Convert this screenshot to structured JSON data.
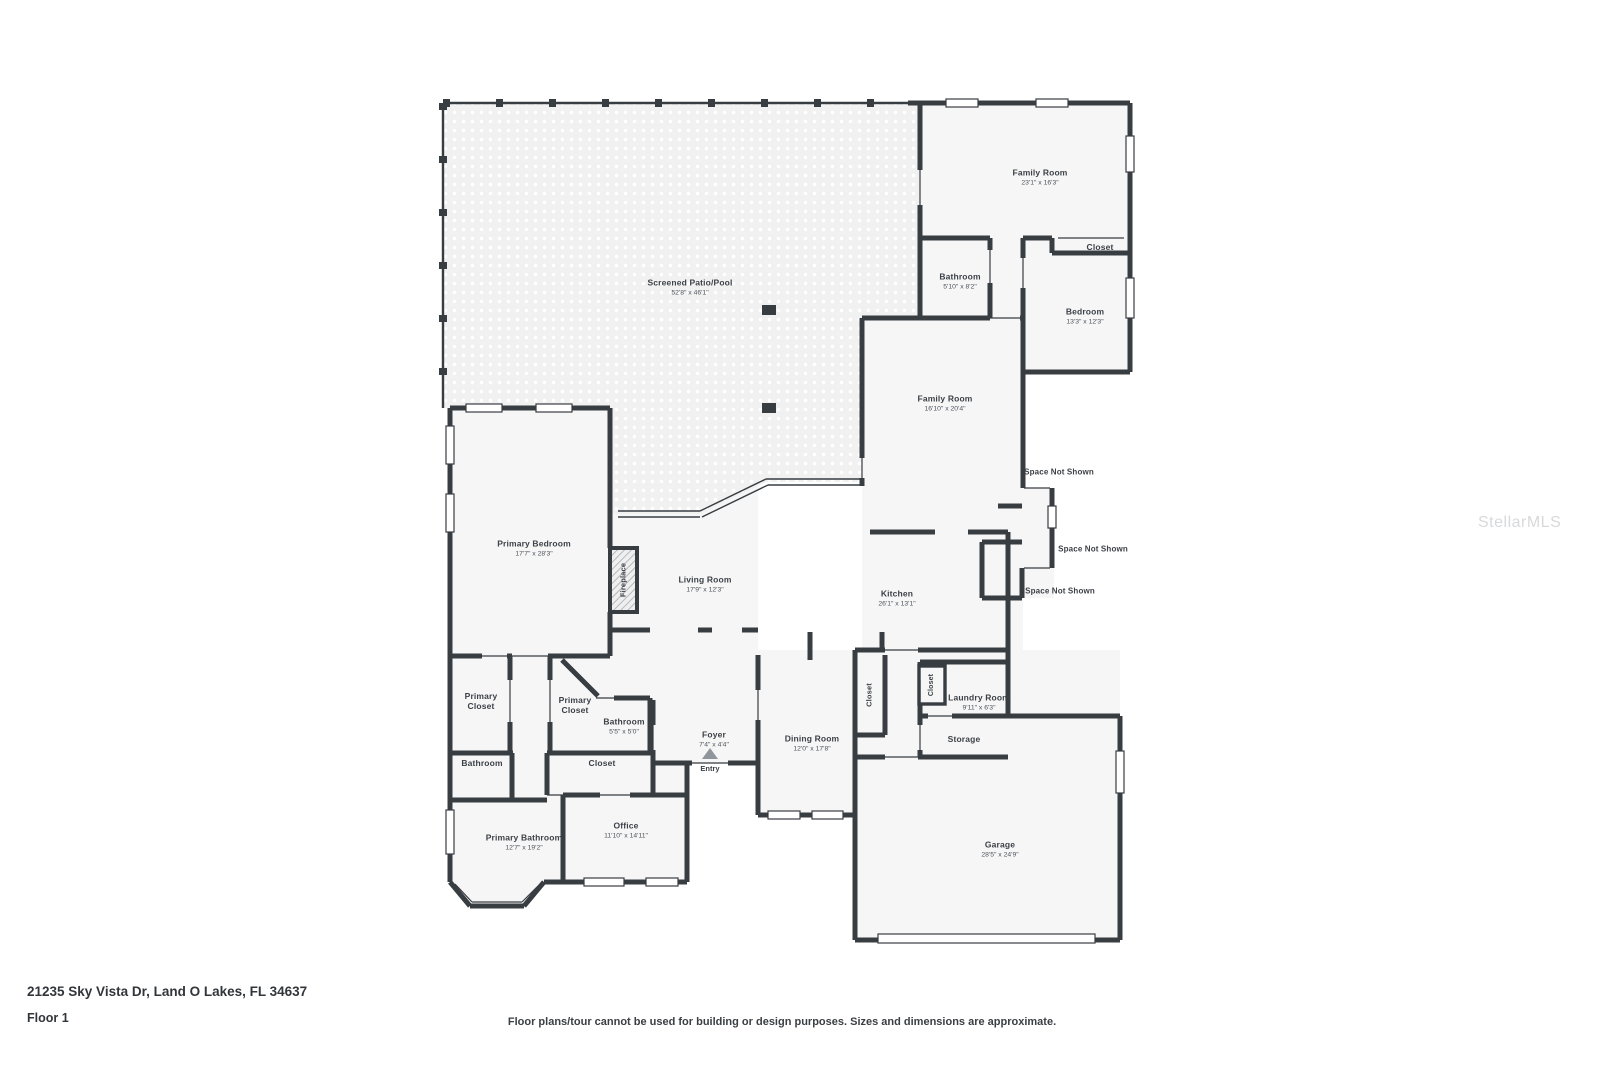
{
  "meta": {
    "address": "21235 Sky Vista Dr, Land O Lakes, FL 34637",
    "floor_label": "Floor 1",
    "disclaimer": "Floor plans/tour cannot be used for building or design purposes. Sizes and dimensions are approximate.",
    "watermark": "StellarMLS"
  },
  "colors": {
    "wall": "#383d42",
    "room_fill": "#f6f6f6",
    "patio_fill": "#f1f1f1",
    "text": "#3c4147",
    "watermark": "#d8d9db"
  },
  "rooms": {
    "screened_patio": {
      "name": "Screened Patio/Pool",
      "dims": "52'8\" x 46'1\""
    },
    "family_room_upper": {
      "name": "Family Room",
      "dims": "23'1\" x 16'3\""
    },
    "closet_upper": {
      "name": "Closet"
    },
    "bathroom_upper": {
      "name": "Bathroom",
      "dims": "5'10\" x 8'2\""
    },
    "bedroom": {
      "name": "Bedroom",
      "dims": "13'3\" x 12'3\""
    },
    "family_room_main": {
      "name": "Family Room",
      "dims": "16'10\" x 20'4\""
    },
    "space_not_shown_1": {
      "name": "Space Not Shown"
    },
    "space_not_shown_2": {
      "name": "Space Not Shown"
    },
    "space_not_shown_3": {
      "name": "Space Not Shown"
    },
    "primary_bedroom": {
      "name": "Primary Bedroom",
      "dims": "17'7\" x 28'3\""
    },
    "fireplace": {
      "name": "Fireplace"
    },
    "living_room": {
      "name": "Living Room",
      "dims": "17'9\" x 12'3\""
    },
    "kitchen": {
      "name": "Kitchen",
      "dims": "26'1\" x 13'1\""
    },
    "primary_closet_left": {
      "name": "Primary Closet"
    },
    "primary_closet_right": {
      "name": "Primary Closet"
    },
    "bathroom_mid": {
      "name": "Bathroom",
      "dims": "5'5\" x 5'0\""
    },
    "closet_tall": {
      "name": "Closet"
    },
    "closet_small": {
      "name": "Closet"
    },
    "laundry_room": {
      "name": "Laundry Room",
      "dims": "9'11\" x 6'3\""
    },
    "foyer": {
      "name": "Foyer",
      "dims": "7'4\" x 4'4\""
    },
    "dining_room": {
      "name": "Dining Room",
      "dims": "12'0\" x 17'8\""
    },
    "storage": {
      "name": "Storage"
    },
    "bathroom_lower": {
      "name": "Bathroom"
    },
    "closet_lower": {
      "name": "Closet"
    },
    "entry": {
      "name": "Entry"
    },
    "office": {
      "name": "Office",
      "dims": "11'10\" x 14'11\""
    },
    "primary_bathroom": {
      "name": "Primary Bathroom",
      "dims": "12'7\" x 19'2\""
    },
    "garage": {
      "name": "Garage",
      "dims": "28'5\" x 24'9\""
    }
  }
}
